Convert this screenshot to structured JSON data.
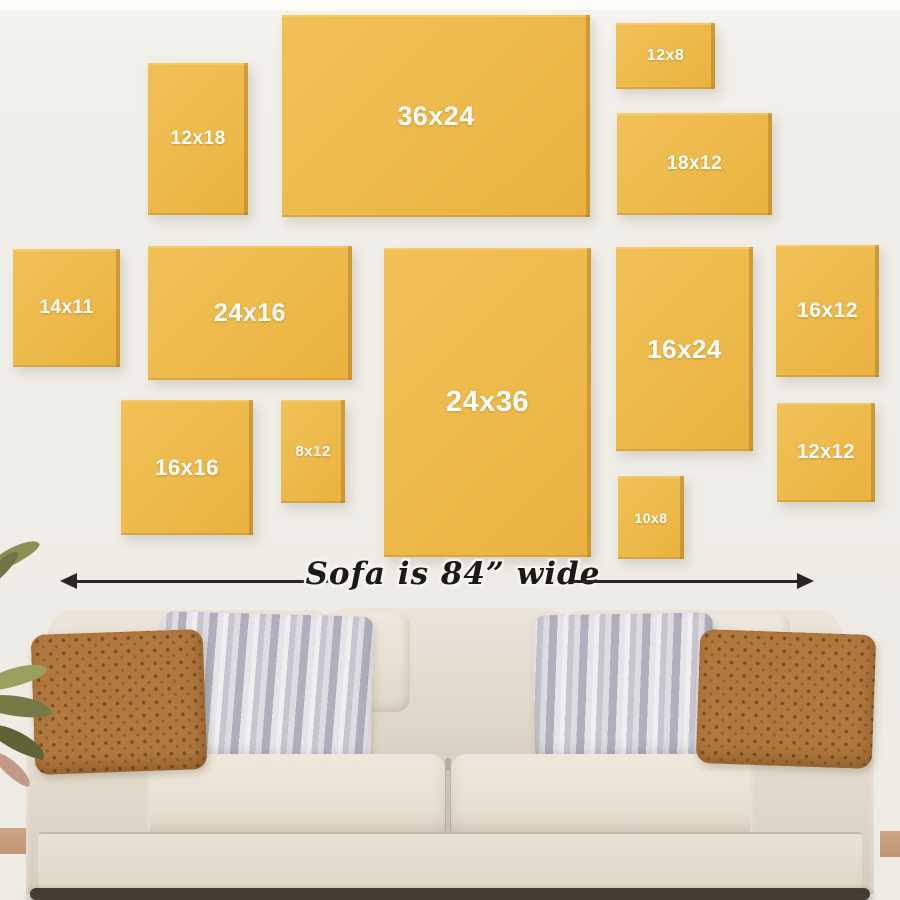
{
  "wall_guide": {
    "accent_color": "#edb94a",
    "wall_color": "#f0eee8",
    "label_color": "#ffffff",
    "frames": [
      {
        "label": "12x18"
      },
      {
        "label": "36x24"
      },
      {
        "label": "12x8"
      },
      {
        "label": "18x12"
      },
      {
        "label": "14x11"
      },
      {
        "label": "24x16"
      },
      {
        "label": "24x36"
      },
      {
        "label": "16x24"
      },
      {
        "label": "16x12"
      },
      {
        "label": "16x16"
      },
      {
        "label": "8x12"
      },
      {
        "label": "12x12"
      },
      {
        "label": "10x8"
      }
    ],
    "measure": {
      "label": "Sofa is 84” wide"
    }
  }
}
